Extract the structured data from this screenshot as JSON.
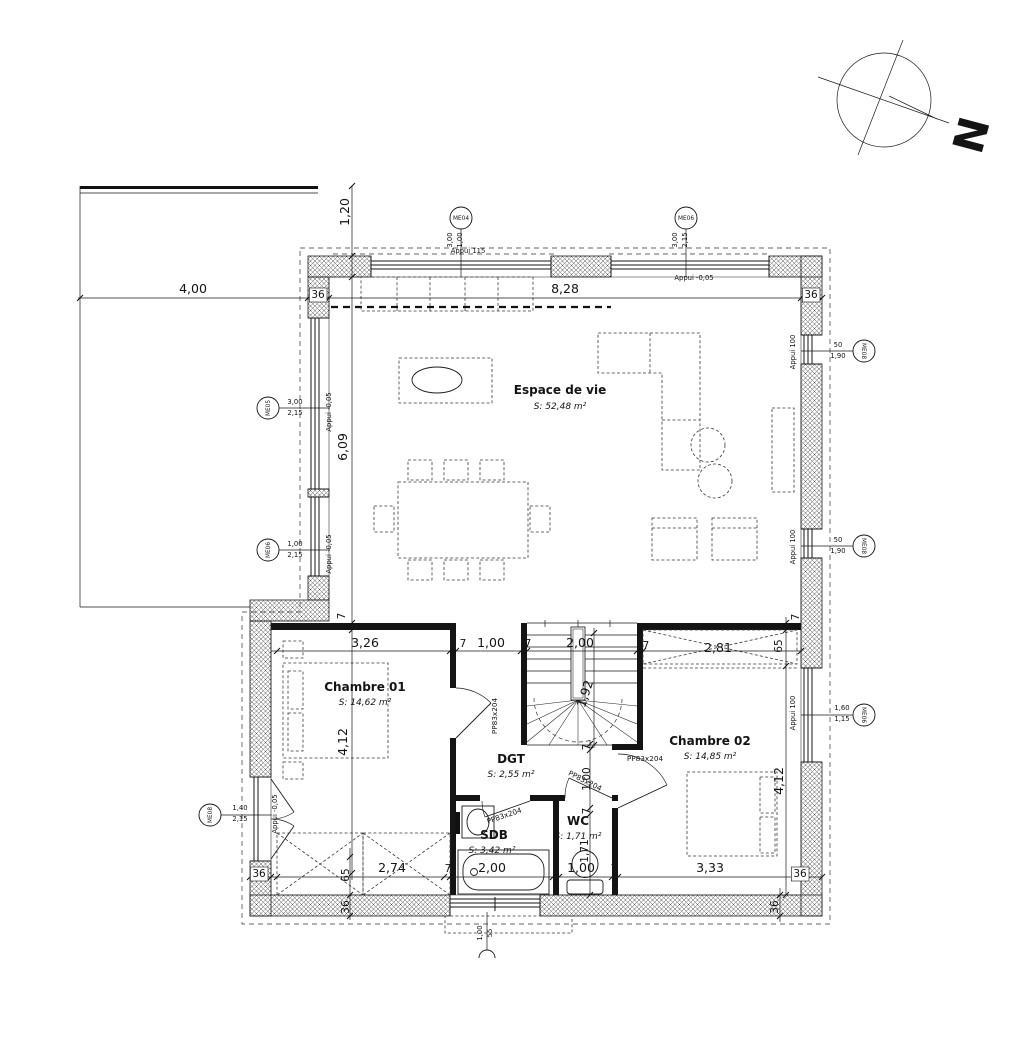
{
  "drawing": {
    "type": "floor-plan",
    "compass_letter": "N",
    "door_type_label": "PP83x204"
  },
  "rooms": [
    {
      "name": "Espace de vie",
      "area": "S: 52,48 m²"
    },
    {
      "name": "Chambre 01",
      "area": "S: 14,62 m²"
    },
    {
      "name": "Chambre 02",
      "area": "S: 14,85 m²"
    },
    {
      "name": "DGT",
      "area": "S: 2,55 m²"
    },
    {
      "name": "SDB",
      "area": "S: 3,42 m²"
    },
    {
      "name": "WC",
      "area": "S: 1,71 m²"
    }
  ],
  "window_tags": [
    {
      "id": "ME04",
      "x": 461,
      "y": 218,
      "r": 0
    },
    {
      "id": "ME06",
      "x": 686,
      "y": 218,
      "r": 0
    },
    {
      "id": "ME05",
      "x": 268,
      "y": 408,
      "r": -90
    },
    {
      "id": "ME06",
      "x": 268,
      "y": 550,
      "r": -90
    },
    {
      "id": "ME08",
      "x": 210,
      "y": 815,
      "r": -90
    },
    {
      "id": "ME08",
      "x": 864,
      "y": 351,
      "r": 90
    },
    {
      "id": "ME08",
      "x": 864,
      "y": 546,
      "r": 90
    },
    {
      "id": "ME06",
      "x": 864,
      "y": 715,
      "r": 90
    }
  ],
  "labels": [
    {
      "t": "4,00",
      "x": 193,
      "y": 293,
      "c": "d",
      "n": "dim-terrace-width"
    },
    {
      "t": "36",
      "x": 318,
      "y": 298,
      "c": "s",
      "box": 1,
      "n": "dim-wall-36"
    },
    {
      "t": "8,28",
      "x": 565,
      "y": 293,
      "c": "d",
      "n": "dim-living-width"
    },
    {
      "t": "36",
      "x": 811,
      "y": 298,
      "c": "s",
      "box": 1,
      "n": "dim-wall-36"
    },
    {
      "t": "1,20",
      "x": 349,
      "y": 212,
      "r": -90,
      "c": "d",
      "n": "dim-1-20"
    },
    {
      "t": "6,09",
      "x": 347,
      "y": 447,
      "r": -90,
      "c": "d",
      "n": "dim-living-depth"
    },
    {
      "t": "4,12",
      "x": 347,
      "y": 742,
      "r": -90,
      "c": "d",
      "n": "dim-chambre01-depth"
    },
    {
      "t": "3,00",
      "x": 452,
      "y": 240,
      "r": -90,
      "c": "t",
      "n": "window-dim"
    },
    {
      "t": "1,00",
      "x": 462,
      "y": 240,
      "r": -90,
      "c": "t",
      "n": "window-dim"
    },
    {
      "t": "Appui 115",
      "x": 468,
      "y": 253,
      "c": "t",
      "n": "sill-label"
    },
    {
      "t": "3,00",
      "x": 677,
      "y": 240,
      "r": -90,
      "c": "t",
      "n": "window-dim"
    },
    {
      "t": "2,15",
      "x": 687,
      "y": 240,
      "r": -90,
      "c": "t",
      "n": "window-dim"
    },
    {
      "t": "Appui -0,05",
      "x": 694,
      "y": 280,
      "c": "t",
      "n": "sill-label"
    },
    {
      "t": "3,00",
      "x": 295,
      "y": 404,
      "c": "t",
      "n": "window-dim"
    },
    {
      "t": "2,15",
      "x": 295,
      "y": 415,
      "c": "t",
      "n": "window-dim"
    },
    {
      "t": "Appui -0,05",
      "x": 331,
      "y": 412,
      "r": -90,
      "c": "t",
      "n": "sill-label"
    },
    {
      "t": "1,00",
      "x": 295,
      "y": 546,
      "c": "t",
      "n": "window-dim"
    },
    {
      "t": "2,15",
      "x": 295,
      "y": 557,
      "c": "t",
      "n": "window-dim"
    },
    {
      "t": "Appui -0,05",
      "x": 331,
      "y": 554,
      "r": -90,
      "c": "t",
      "n": "sill-label"
    },
    {
      "t": "1,40",
      "x": 240,
      "y": 810,
      "c": "t",
      "n": "window-dim"
    },
    {
      "t": "2,15",
      "x": 240,
      "y": 821,
      "c": "t",
      "n": "window-dim"
    },
    {
      "t": "Appui -0,05",
      "x": 277,
      "y": 814,
      "r": -90,
      "c": "t",
      "n": "sill-label"
    },
    {
      "t": "50",
      "x": 838,
      "y": 347,
      "c": "t",
      "n": "window-dim"
    },
    {
      "t": "1,90",
      "x": 838,
      "y": 358,
      "c": "t",
      "n": "window-dim"
    },
    {
      "t": "Appui 100",
      "x": 795,
      "y": 352,
      "r": -90,
      "c": "t",
      "n": "sill-label"
    },
    {
      "t": "50",
      "x": 838,
      "y": 542,
      "c": "t",
      "n": "window-dim"
    },
    {
      "t": "1,90",
      "x": 838,
      "y": 553,
      "c": "t",
      "n": "window-dim"
    },
    {
      "t": "Appui 100",
      "x": 795,
      "y": 547,
      "r": -90,
      "c": "t",
      "n": "sill-label"
    },
    {
      "t": "1,60",
      "x": 842,
      "y": 710,
      "c": "t",
      "n": "window-dim"
    },
    {
      "t": "1,15",
      "x": 842,
      "y": 721,
      "c": "t",
      "n": "window-dim"
    },
    {
      "t": "Appui 100",
      "x": 795,
      "y": 713,
      "r": -90,
      "c": "t",
      "n": "sill-label"
    },
    {
      "t": "Espace de vie",
      "x": 560,
      "y": 394,
      "c": "rm",
      "n": "room-name-espace-de-vie"
    },
    {
      "t": "S: 52,48 m²",
      "x": 560,
      "y": 409,
      "c": "ar",
      "n": "room-area-espace-de-vie"
    },
    {
      "t": "Chambre 01",
      "x": 365,
      "y": 691,
      "c": "rm",
      "n": "room-name-chambre-01"
    },
    {
      "t": "S: 14,62 m²",
      "x": 365,
      "y": 705,
      "c": "ar",
      "n": "room-area-chambre-01"
    },
    {
      "t": "Chambre 02",
      "x": 710,
      "y": 745,
      "c": "rm",
      "n": "room-name-chambre-02"
    },
    {
      "t": "S: 14,85 m²",
      "x": 710,
      "y": 759,
      "c": "ar",
      "n": "room-area-chambre-02"
    },
    {
      "t": "DGT",
      "x": 511,
      "y": 763,
      "c": "rm",
      "n": "room-name-dgt"
    },
    {
      "t": "S: 2,55 m²",
      "x": 511,
      "y": 777,
      "c": "ar",
      "n": "room-area-dgt"
    },
    {
      "t": "SDB",
      "x": 494,
      "y": 839,
      "c": "rm",
      "n": "room-name-sdb"
    },
    {
      "t": "S: 3,42 m²",
      "x": 492,
      "y": 853,
      "c": "ar",
      "n": "room-area-sdb"
    },
    {
      "t": "WC",
      "x": 578,
      "y": 825,
      "c": "rm",
      "n": "room-name-wc"
    },
    {
      "t": "S: 1,71 m²",
      "x": 578,
      "y": 839,
      "c": "ar",
      "n": "room-area-wc"
    },
    {
      "t": "7",
      "x": 345,
      "y": 616,
      "r": -90,
      "c": "s",
      "n": "dim-7"
    },
    {
      "t": "3,26",
      "x": 365,
      "y": 647,
      "c": "d",
      "n": "dim-3-26"
    },
    {
      "t": "7",
      "x": 463,
      "y": 647,
      "c": "s",
      "n": "dim-7"
    },
    {
      "t": "1,00",
      "x": 491,
      "y": 647,
      "c": "d",
      "n": "dim-1-00"
    },
    {
      "t": "7",
      "x": 528,
      "y": 647,
      "c": "s",
      "n": "dim-7"
    },
    {
      "t": "2,00",
      "x": 580,
      "y": 647,
      "c": "d",
      "n": "dim-stairs-width"
    },
    {
      "t": "7",
      "x": 646,
      "y": 649,
      "c": "s",
      "n": "dim-7"
    },
    {
      "t": "2,81",
      "x": 718,
      "y": 652,
      "c": "d",
      "n": "dim-closet-width"
    },
    {
      "t": "65",
      "x": 782,
      "y": 646,
      "r": -90,
      "c": "s",
      "n": "dim-65"
    },
    {
      "t": "7",
      "x": 799,
      "y": 617,
      "r": -90,
      "c": "s",
      "n": "dim-7"
    },
    {
      "t": "1,92",
      "x": 589,
      "y": 695,
      "r": -72,
      "c": "d",
      "n": "dim-stairs-depth"
    },
    {
      "t": "7",
      "x": 590,
      "y": 747,
      "r": -90,
      "c": "s",
      "n": "dim-7"
    },
    {
      "t": "1,00",
      "x": 590,
      "y": 779,
      "r": -90,
      "c": "s",
      "n": "dim-door-opening"
    },
    {
      "t": "7",
      "x": 590,
      "y": 811,
      "r": -90,
      "c": "s",
      "n": "dim-7"
    },
    {
      "t": "1,71",
      "x": 588,
      "y": 851,
      "r": -90,
      "c": "s",
      "n": "dim-wc-depth"
    },
    {
      "t": "4,12",
      "x": 783,
      "y": 781,
      "r": -90,
      "c": "d",
      "n": "dim-chambre02-depth"
    },
    {
      "t": "PP83x204",
      "x": 497,
      "y": 716,
      "r": -90,
      "c": "dr",
      "n": "door-label-chambre01"
    },
    {
      "t": "PP83x204",
      "x": 505,
      "y": 818,
      "r": -19,
      "c": "dr",
      "n": "door-label-sdb"
    },
    {
      "t": "PP83x204",
      "x": 584,
      "y": 783,
      "r": 27,
      "c": "dr",
      "n": "door-label-wc"
    },
    {
      "t": "PP83x204",
      "x": 645,
      "y": 761,
      "c": "dr",
      "n": "door-label-chambre02"
    },
    {
      "t": "36",
      "x": 259,
      "y": 877,
      "c": "s",
      "box": 1,
      "n": "dim-wall-36"
    },
    {
      "t": "65",
      "x": 349,
      "y": 875,
      "r": -90,
      "c": "s",
      "n": "dim-65"
    },
    {
      "t": "2,74",
      "x": 392,
      "y": 872,
      "c": "d",
      "n": "dim-2-74"
    },
    {
      "t": "7",
      "x": 448,
      "y": 872,
      "c": "s",
      "n": "dim-7"
    },
    {
      "t": "2,00",
      "x": 492,
      "y": 872,
      "c": "d",
      "n": "dim-sdb-width"
    },
    {
      "t": "7",
      "x": 556,
      "y": 872,
      "c": "s",
      "n": "dim-7"
    },
    {
      "t": "1,00",
      "x": 581,
      "y": 872,
      "c": "d",
      "n": "dim-wc-width"
    },
    {
      "t": "7",
      "x": 614,
      "y": 872,
      "c": "s",
      "n": "dim-7"
    },
    {
      "t": "3,33",
      "x": 710,
      "y": 872,
      "c": "d",
      "n": "dim-chambre02-width"
    },
    {
      "t": "36",
      "x": 800,
      "y": 877,
      "c": "s",
      "box": 1,
      "n": "dim-wall-36"
    },
    {
      "t": "36",
      "x": 349,
      "y": 907,
      "r": -90,
      "c": "s",
      "n": "dim-wall-36"
    },
    {
      "t": "36",
      "x": 778,
      "y": 907,
      "r": -90,
      "c": "s",
      "n": "dim-wall-36"
    },
    {
      "t": "1,00",
      "x": 482,
      "y": 933,
      "r": -90,
      "c": "t",
      "n": "entry-dim"
    },
    {
      "t": "55",
      "x": 492,
      "y": 933,
      "r": -90,
      "c": "t",
      "n": "entry-dim"
    },
    {
      "t": "N",
      "x": 956,
      "y": 131,
      "r": 105,
      "c": "n",
      "n": "north-letter"
    }
  ]
}
